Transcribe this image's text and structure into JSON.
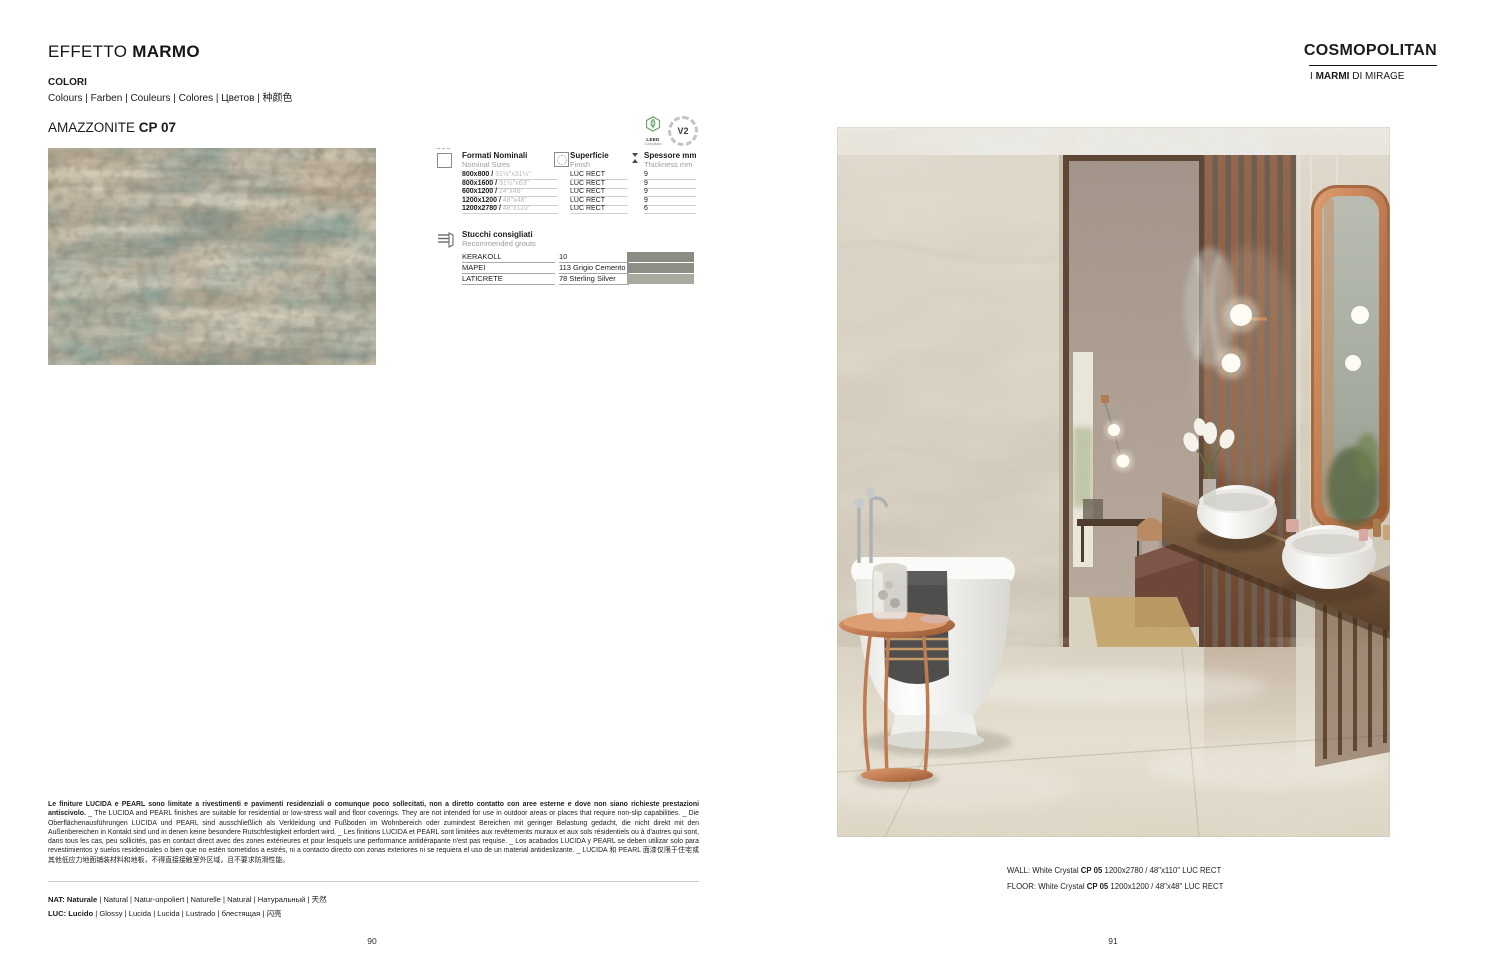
{
  "left": {
    "title_regular": "EFFETTO ",
    "title_bold": "MARMO",
    "colori_label": "COLORI",
    "colori_translations": "Colours | Farben | Couleurs | Colores | Цветов | 种颜色",
    "product_name": "AMAZZONITE ",
    "product_code": "CP 07",
    "table": {
      "col1_title": "Formati Nominali",
      "col1_sub": "Nominal Sizes",
      "col2_title": "Superficie",
      "col2_sub": "Finish",
      "col3_title": "Spessore mm",
      "col3_sub": "Thickness mm",
      "rows": [
        {
          "size_mm": "800x800 / ",
          "size_in": "31½\"x31½\"",
          "finish": "LUC RECT",
          "thickness": "9"
        },
        {
          "size_mm": "800x1600 / ",
          "size_in": "31½\"x63\"",
          "finish": "LUC RECT",
          "thickness": "9"
        },
        {
          "size_mm": "600x1200 / ",
          "size_in": "24\"x48\"",
          "finish": "LUC RECT",
          "thickness": "9"
        },
        {
          "size_mm": "1200x1200 / ",
          "size_in": "48\"x48\"",
          "finish": "LUC RECT",
          "thickness": "9"
        },
        {
          "size_mm": "1200x2780 / ",
          "size_in": "48\"x110\"",
          "finish": "LUC RECT",
          "thickness": "6"
        }
      ]
    },
    "badges": {
      "leed_line1": "LEED",
      "leed_line2": "Compliant",
      "v2": "V2"
    },
    "grouts": {
      "title": "Stucchi consigliati",
      "subtitle": "Recommended grouts",
      "rows": [
        {
          "brand": "KERAKOLL",
          "code": "10",
          "color": "#8c8c84"
        },
        {
          "brand": "MAPEI",
          "code": "113 Grigio Cemento",
          "color": "#8e8e86"
        },
        {
          "brand": "LATICRETE",
          "code": "78 Sterling Silver",
          "color": "#a9a99e"
        }
      ]
    },
    "disclaimer_bold": "Le finiture LUCIDA e PEARL sono limitate a rivestimenti e pavimenti residenziali o comunque poco sollecitati, non a diretto contatto con aree esterne e dove non siano richieste prestazioni antiscivolo.",
    "disclaimer_rest": " _ The LUCIDA and PEARL finishes are suitable for residential or low-stress wall and floor coverings. They are not intended for use in outdoor areas or places that require non-slip capabilities. _ Die Oberflächenausführungen LUCIDA und PEARL sind ausschließlich als Verkleidung und Fußboden im Wohnbereich oder zumindest Bereichen mit geringer Belastung gedacht, die nicht direkt mit den Außenbereichen in Kontakt sind und in denen keine besondere Rutschfestigkeit erfordert wird. _ Les finitions LUCIDA et PEARL sont limitées aux revêtements muraux et aux sols résidentiels ou à d'autres qui sont, dans tous les cas, peu sollicités, pas en contact direct avec des zones extérieures et pour lesquels une performance antidérapante n'est pas requise. _ Los acabados LUCIDA y PEARL se deben utilizar solo para revestimientos y suelos residenciales o bien que no estén sometidos a estrés, ni a contacto directo con zonas exteriores ni se requiera el uso de un material antideslizante. _ LUCIDA 和 PEARL 面漆仅限于住宅或其他低应力地面铺装材料和地板，不得直接接触室外区域，且不要求防滑性能。",
    "legend_nat_bold": "NAT: Naturale",
    "legend_nat_rest": " | Natural | Natur-unpoliert | Naturelle | Natural | Натуральный | 天然",
    "legend_luc_bold": "LUC: Lucido",
    "legend_luc_rest": " | Glossy | Lucida | Lucida | Lustrado | блестящая | 闪亮",
    "page_number": "90"
  },
  "right": {
    "title": "COSMOPOLITAN",
    "subtitle_pre": "I ",
    "subtitle_bold": "MARMI",
    "subtitle_post": " DI MIRAGE",
    "caption_wall_pre": "WALL: White Crystal ",
    "caption_wall_code": "CP 05",
    "caption_wall_post": " 1200x2780 / 48\"x110\" LUC RECT",
    "caption_floor_pre": "FLOOR: White Crystal ",
    "caption_floor_code": "CP 05",
    "caption_floor_post": " 1200x1200 / 48\"x48\" LUC RECT",
    "page_number": "91"
  }
}
